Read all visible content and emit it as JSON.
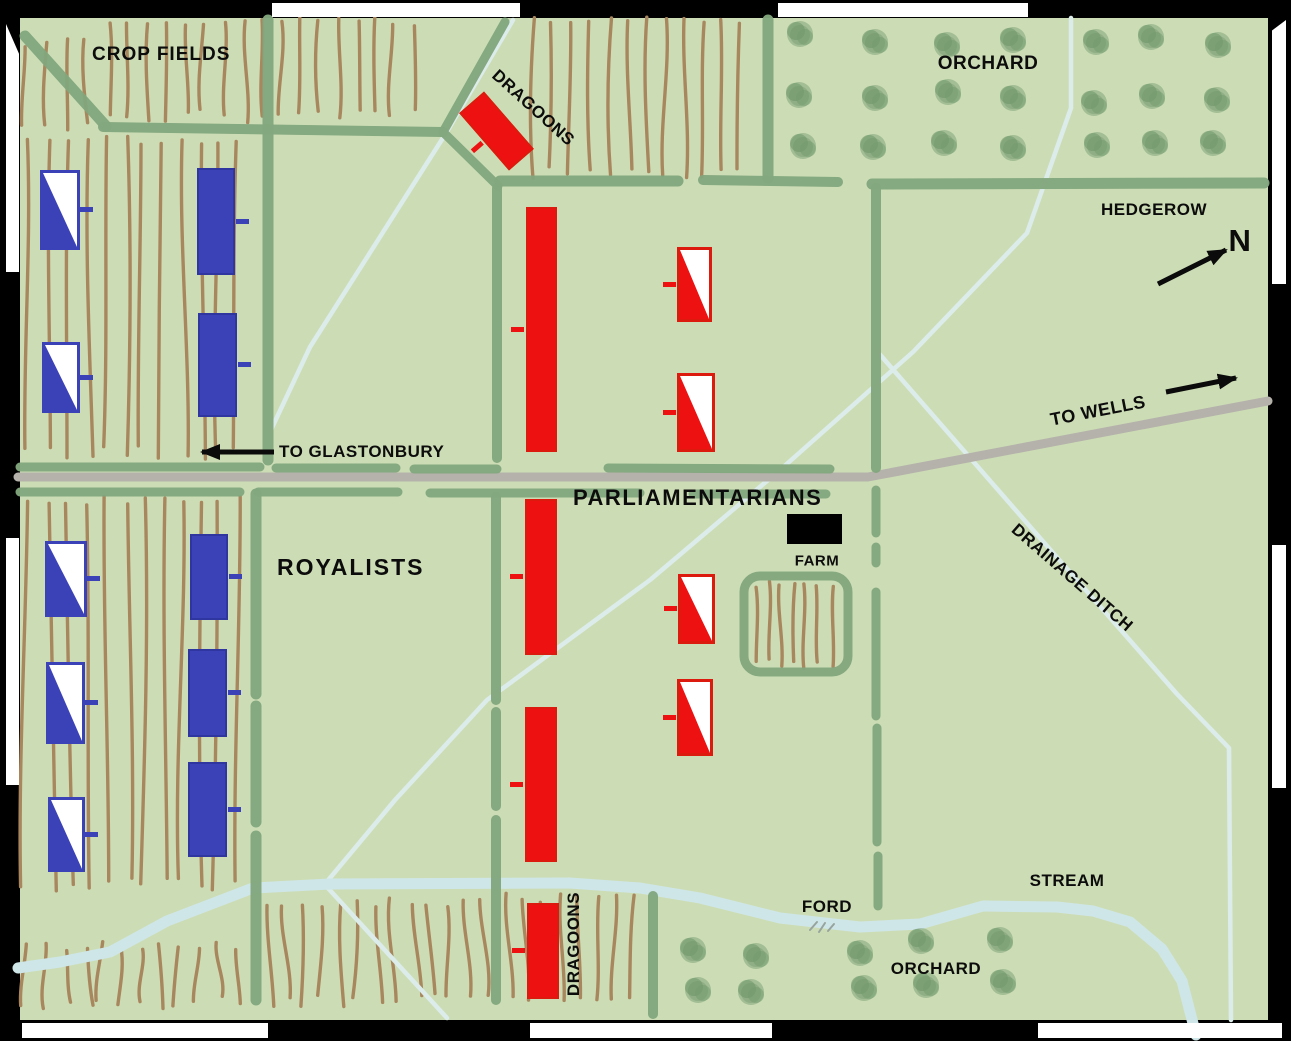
{
  "labels": {
    "crop_fields": "CROP FIELDS",
    "dragoons_north": "DRAGOONS",
    "orchard_north": "ORCHARD",
    "hedgerow": "HEDGEROW",
    "compass_north": "N",
    "to_wells": "TO WELLS",
    "to_glastonbury": "TO GLASTONBURY",
    "parliamentarians": "PARLIAMENTARIANS",
    "royalists": "ROYALISTS",
    "farm": "FARM",
    "drainage_ditch": "DRAINAGE DITCH",
    "stream": "STREAM",
    "ford": "FORD",
    "orchard_south": "ORCHARD",
    "dragoons_south": "DRAGOONS"
  },
  "colors": {
    "background": "#ccddb5",
    "hedge": "#83a77e",
    "crop_row": "#a8875f",
    "road": "#b5b2ab",
    "ditch": "#dceceb",
    "stream": "#cfe6e8",
    "royalist_blue": "#3b41b7",
    "parliament_red": "#ee1111",
    "tree": "#7aa075",
    "tree_dark": "#6c9366",
    "farm_black": "#000000",
    "arrow_black": "#0b0b0b",
    "ford_mark": "#97a49e"
  },
  "units": {
    "royalists": [
      {
        "id": "royalist-unit-1",
        "symbol": "blue-white-diagonal",
        "x": 40,
        "y": 170,
        "w": 40,
        "h": 80,
        "tick": "right"
      },
      {
        "id": "royalist-unit-2",
        "symbol": "solid-blue",
        "x": 197,
        "y": 168,
        "w": 38,
        "h": 107,
        "tick": "right"
      },
      {
        "id": "royalist-unit-3",
        "symbol": "blue-white-diagonal",
        "x": 42,
        "y": 342,
        "w": 38,
        "h": 71,
        "tick": "right"
      },
      {
        "id": "royalist-unit-4",
        "symbol": "solid-blue",
        "x": 198,
        "y": 313,
        "w": 39,
        "h": 104,
        "tick": "right"
      },
      {
        "id": "royalist-unit-5",
        "symbol": "blue-white-diagonal",
        "x": 45,
        "y": 541,
        "w": 42,
        "h": 76,
        "tick": "right"
      },
      {
        "id": "royalist-unit-6",
        "symbol": "solid-blue",
        "x": 190,
        "y": 534,
        "w": 38,
        "h": 86,
        "tick": "right"
      },
      {
        "id": "royalist-unit-7",
        "symbol": "blue-white-diagonal",
        "x": 46,
        "y": 662,
        "w": 39,
        "h": 82,
        "tick": "right"
      },
      {
        "id": "royalist-unit-8",
        "symbol": "solid-blue",
        "x": 188,
        "y": 649,
        "w": 39,
        "h": 88,
        "tick": "right"
      },
      {
        "id": "royalist-unit-9",
        "symbol": "blue-white-diagonal",
        "x": 48,
        "y": 797,
        "w": 37,
        "h": 75,
        "tick": "right"
      },
      {
        "id": "royalist-unit-10",
        "symbol": "solid-blue",
        "x": 188,
        "y": 762,
        "w": 39,
        "h": 95,
        "tick": "right"
      }
    ],
    "parliamentarians": [
      {
        "id": "parliament-dragoons-north",
        "symbol": "solid-red",
        "x": 480,
        "y": 93,
        "w": 33,
        "h": 76,
        "rot": -41,
        "tick": "left"
      },
      {
        "id": "parliament-unit-1",
        "symbol": "solid-red",
        "x": 526,
        "y": 207,
        "w": 31,
        "h": 245,
        "tick": "left"
      },
      {
        "id": "parliament-unit-2",
        "symbol": "red-white-diagonal",
        "x": 677,
        "y": 247,
        "w": 35,
        "h": 75,
        "tick": "left"
      },
      {
        "id": "parliament-unit-3",
        "symbol": "red-white-diagonal",
        "x": 677,
        "y": 373,
        "w": 38,
        "h": 79,
        "tick": "left"
      },
      {
        "id": "parliament-unit-4",
        "symbol": "solid-red",
        "x": 525,
        "y": 499,
        "w": 32,
        "h": 156,
        "tick": "left"
      },
      {
        "id": "parliament-unit-5",
        "symbol": "red-white-diagonal",
        "x": 678,
        "y": 574,
        "w": 37,
        "h": 70,
        "tick": "left"
      },
      {
        "id": "parliament-unit-6",
        "symbol": "red-white-diagonal",
        "x": 677,
        "y": 679,
        "w": 36,
        "h": 77,
        "tick": "left"
      },
      {
        "id": "parliament-unit-7",
        "symbol": "solid-red",
        "x": 525,
        "y": 707,
        "w": 32,
        "h": 155,
        "tick": "left"
      },
      {
        "id": "parliament-dragoons-south",
        "symbol": "solid-red",
        "x": 527,
        "y": 903,
        "w": 32,
        "h": 96,
        "tick": "left"
      }
    ]
  },
  "terrain": {
    "map_rect": [
      20,
      18,
      1248,
      1002
    ],
    "hedges": [
      [
        25,
        36,
        106,
        126,
        11
      ],
      [
        103,
        127,
        443,
        132,
        10
      ],
      [
        505,
        22,
        443,
        132,
        9
      ],
      [
        443,
        132,
        498,
        186,
        9
      ],
      [
        500,
        181,
        678,
        181,
        11
      ],
      [
        703,
        180,
        838,
        182,
        10
      ],
      [
        872,
        184,
        1264,
        183,
        11
      ],
      [
        768,
        20,
        768,
        178,
        11
      ],
      [
        876,
        188,
        876,
        468,
        10
      ],
      [
        876,
        490,
        876,
        533,
        9
      ],
      [
        876,
        547,
        876,
        563,
        9
      ],
      [
        876,
        592,
        876,
        716,
        9
      ],
      [
        877,
        728,
        877,
        842,
        9
      ],
      [
        878,
        856,
        878,
        906,
        9
      ],
      [
        268,
        20,
        268,
        460,
        11
      ],
      [
        256,
        494,
        256,
        694,
        11
      ],
      [
        256,
        706,
        256,
        822,
        11
      ],
      [
        256,
        836,
        256,
        1000,
        11
      ],
      [
        497,
        188,
        497,
        458,
        10
      ],
      [
        496,
        497,
        496,
        700,
        10
      ],
      [
        496,
        712,
        496,
        806,
        10
      ],
      [
        496,
        820,
        496,
        1000,
        10
      ],
      [
        653,
        896,
        653,
        1014,
        10
      ],
      [
        20,
        467,
        260,
        467,
        9
      ],
      [
        276,
        468,
        396,
        468,
        9
      ],
      [
        414,
        469,
        497,
        469,
        9
      ],
      [
        608,
        468,
        830,
        469,
        9
      ],
      [
        20,
        492,
        240,
        492,
        9
      ],
      [
        258,
        492,
        398,
        492,
        9
      ],
      [
        430,
        493,
        640,
        493,
        9
      ],
      [
        693,
        494,
        826,
        494,
        9
      ]
    ],
    "farm_enclosure": [
      744,
      576,
      104,
      96
    ],
    "farm_building": {
      "x": 787,
      "y": 514,
      "w": 55,
      "h": 30
    },
    "road": "M18,477 L868,477 L1268,401",
    "ditches": [
      "M513,20 L448,130 L310,347 L270,432",
      "M1071,18 L1071,108 L1027,233 L913,352 L780,470 L650,580 L487,700 L395,800 L325,884",
      "M876,350 L1040,538 L1177,694 L1229,748 L1231,1020",
      "M327,887 L447,1018"
    ],
    "stream": "M18,968 L60,962 L110,952 L167,921 L253,888 L330,884 L570,883 L640,888 L700,898 L780,918 L860,927 L920,924 L983,906 L1057,907 L1093,911 L1130,922 L1162,949 L1182,981 L1196,1035",
    "ford_marks": [
      "M810,930 l7,-8",
      "M819,932 l6,-9",
      "M828,931 l6,-7"
    ],
    "fields": [
      {
        "x1": 28,
        "y1": 42,
        "x2": 100,
        "y2": 128,
        "sp": 19,
        "slant": 4,
        "seed": 7
      },
      {
        "x1": 110,
        "y1": 22,
        "x2": 428,
        "y2": 116,
        "sp": 19,
        "slant": 4,
        "seed": 11
      },
      {
        "x1": 534,
        "y1": 22,
        "x2": 688,
        "y2": 172,
        "sp": 19,
        "slant": 5,
        "seed": 13
      },
      {
        "x1": 703,
        "y1": 22,
        "x2": 758,
        "y2": 172,
        "sp": 19,
        "slant": 4,
        "seed": 17
      },
      {
        "x1": 30,
        "y1": 140,
        "x2": 246,
        "y2": 452,
        "sp": 19,
        "slant": 7,
        "seed": 19
      },
      {
        "x1": 30,
        "y1": 500,
        "x2": 246,
        "y2": 884,
        "sp": 19,
        "slant": 8,
        "seed": 23
      },
      {
        "x1": 28,
        "y1": 946,
        "x2": 250,
        "y2": 1002,
        "sp": 19,
        "slant": 8,
        "seed": 29
      },
      {
        "x1": 266,
        "y1": 903,
        "x2": 486,
        "y2": 1000,
        "sp": 18,
        "slant": 10,
        "seed": 31
      },
      {
        "x1": 506,
        "y1": 898,
        "x2": 645,
        "y2": 1000,
        "sp": 18,
        "slant": 7,
        "seed": 37
      },
      {
        "x1": 754,
        "y1": 586,
        "x2": 842,
        "y2": 662,
        "sp": 13,
        "slant": 3,
        "seed": 41
      }
    ],
    "orchard_north_trees": [
      [
        800,
        34
      ],
      [
        875,
        42
      ],
      [
        947,
        45
      ],
      [
        1013,
        40
      ],
      [
        1096,
        42
      ],
      [
        1151,
        37
      ],
      [
        1218,
        45
      ],
      [
        799,
        95
      ],
      [
        875,
        98
      ],
      [
        948,
        92
      ],
      [
        1013,
        98
      ],
      [
        1094,
        103
      ],
      [
        1152,
        96
      ],
      [
        1217,
        100
      ],
      [
        803,
        146
      ],
      [
        873,
        147
      ],
      [
        944,
        143
      ],
      [
        1013,
        148
      ],
      [
        1097,
        145
      ],
      [
        1155,
        143
      ],
      [
        1213,
        143
      ]
    ],
    "orchard_south_trees": [
      [
        693,
        950
      ],
      [
        698,
        990
      ],
      [
        756,
        956
      ],
      [
        751,
        992
      ],
      [
        860,
        953
      ],
      [
        864,
        988
      ],
      [
        921,
        941
      ],
      [
        926,
        985
      ],
      [
        1000,
        940
      ],
      [
        1003,
        982
      ]
    ],
    "arrows": [
      {
        "name": "to-glastonbury-arrow",
        "path": "M274,452 L202,452"
      },
      {
        "name": "to-wells-arrow",
        "path": "M1166,392 L1236,378"
      },
      {
        "name": "compass-north-arrow",
        "path": "M1158,284 L1226,250"
      }
    ]
  },
  "border_notches": [
    [
      272,
      3,
      248,
      14
    ],
    [
      778,
      3,
      250,
      14
    ],
    [
      22,
      1023,
      246,
      15
    ],
    [
      530,
      1023,
      242,
      15
    ],
    [
      1038,
      1023,
      244,
      15
    ],
    [
      6,
      24,
      13,
      248
    ],
    [
      6,
      538,
      13,
      247
    ],
    [
      1272,
      20,
      14,
      264
    ],
    [
      1272,
      545,
      14,
      243
    ]
  ]
}
